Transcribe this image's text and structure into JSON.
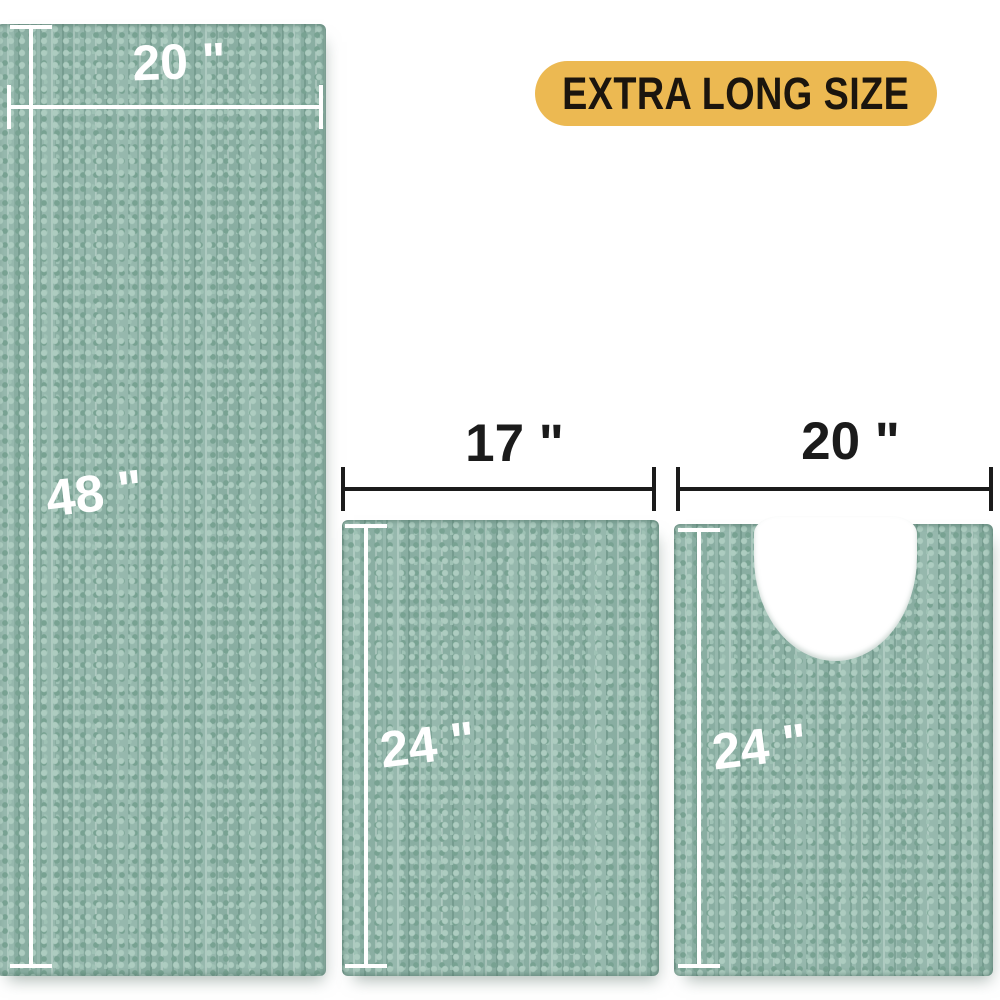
{
  "badge": {
    "label": "EXTRA LONG SIZE"
  },
  "rugs": [
    {
      "name": "extra-long-runner",
      "shape": "rectangle",
      "width": "20 \"",
      "length": "48 \""
    },
    {
      "name": "bath-mat",
      "shape": "rectangle",
      "width": "17 \"",
      "length": "24 \""
    },
    {
      "name": "contour-mat",
      "shape": "u-shaped-contour",
      "width": "20 \"",
      "length": "24 \""
    }
  ],
  "colors": {
    "background": "#FFFFFF",
    "rug_base": "#8FB4A8",
    "rug_dot_light": "#ADCCC0",
    "rug_dot_dark": "#78A292",
    "dimension_line_white": "#FFFFFF",
    "dimension_line_black": "#1B1B1B",
    "badge_background": "#ECB952",
    "badge_text": "#1B150E"
  }
}
